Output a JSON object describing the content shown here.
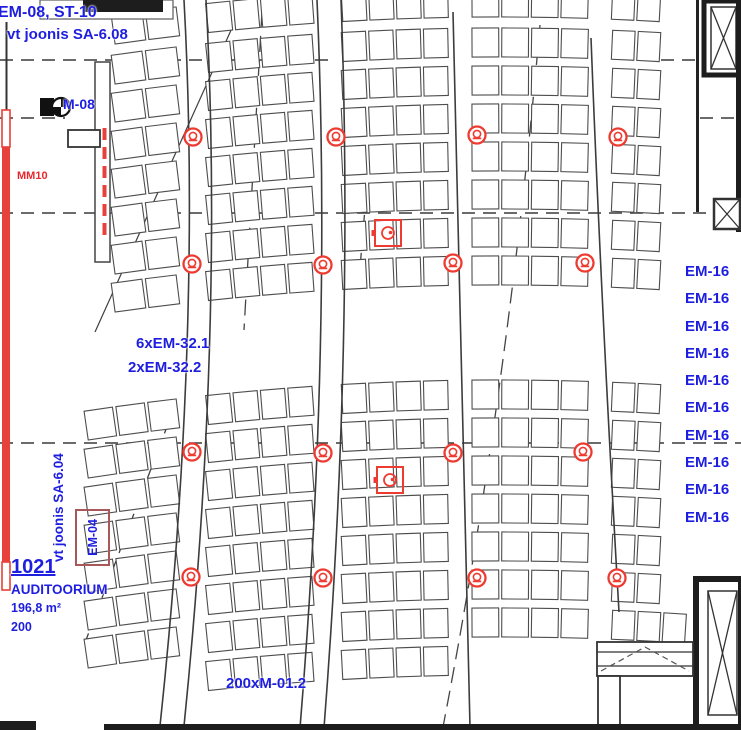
{
  "meta": {
    "drawing_type": "cad-floor-plan",
    "view": "auditorium seating plan"
  },
  "colors": {
    "annotation_blue": "#1e1ee0",
    "device_red": "#ee3b32",
    "mm10_red": "#e8272d",
    "seat_line": "#4d4d4d",
    "wall_black": "#1d1d1d",
    "em04_box_red": "#a85858"
  },
  "labels": {
    "ref_top_line1": "EM-08, ST-10",
    "ref_top_line2": "vt joonis SA-6.08",
    "m08": "M-08",
    "mm10": "MM10",
    "em32_line1": "6xEM-32.1",
    "em32_line2": "2xEM-32.2",
    "em16": "EM-16",
    "em04": "EM-04",
    "ref_left_vertical": "vt joonis SA-6.04",
    "room_number": "1021",
    "room_name": "AUDITOORIUM",
    "room_area": "196,8 m²",
    "room_capacity": "200",
    "seat_count_label": "200xM-01.2"
  },
  "em16_count": 10,
  "symbols": {
    "speakers": [
      [
        193,
        137
      ],
      [
        336,
        137
      ],
      [
        477,
        135
      ],
      [
        618,
        137
      ],
      [
        192,
        264
      ],
      [
        323,
        265
      ],
      [
        453,
        263
      ],
      [
        585,
        263
      ],
      [
        192,
        452
      ],
      [
        323,
        453
      ],
      [
        453,
        453
      ],
      [
        583,
        452
      ],
      [
        191,
        577
      ],
      [
        323,
        578
      ],
      [
        477,
        578
      ],
      [
        617,
        578
      ]
    ],
    "detectors": [
      [
        388,
        233
      ],
      [
        390,
        480
      ]
    ]
  },
  "seating": {
    "row_height": 29,
    "curve_center_x": 500,
    "curve_k": 5500,
    "upper_rows": [
      -12,
      28,
      66,
      104,
      142,
      180,
      218,
      256
    ],
    "lower_rows": [
      380,
      418,
      456,
      494,
      532,
      570,
      608,
      646
    ],
    "upper_banks": [
      {
        "x": 113,
        "w": 68,
        "n": 2
      },
      {
        "x": 207,
        "w": 109,
        "n": 4
      },
      {
        "x": 342,
        "w": 109,
        "n": 4
      },
      {
        "x": 472,
        "w": 119,
        "n": 4
      },
      {
        "x": 612,
        "w": 51,
        "n": 2
      }
    ],
    "lower_banks": [
      {
        "x": 86,
        "w": 95,
        "n": 3
      },
      {
        "x": 207,
        "w": 109,
        "n": 4
      },
      {
        "x": 342,
        "w": 109,
        "n": 4
      },
      {
        "x": 472,
        "w": 119,
        "n": 4
      },
      {
        "x": 612,
        "w": 51,
        "n": 2
      }
    ],
    "lower_restrictions": {
      "608": {
        "banks": [
          0,
          1,
          2,
          3,
          4
        ],
        "seat_limit": {
          "4": 3
        }
      },
      "646": {
        "banks": [
          1,
          2
        ]
      }
    }
  }
}
